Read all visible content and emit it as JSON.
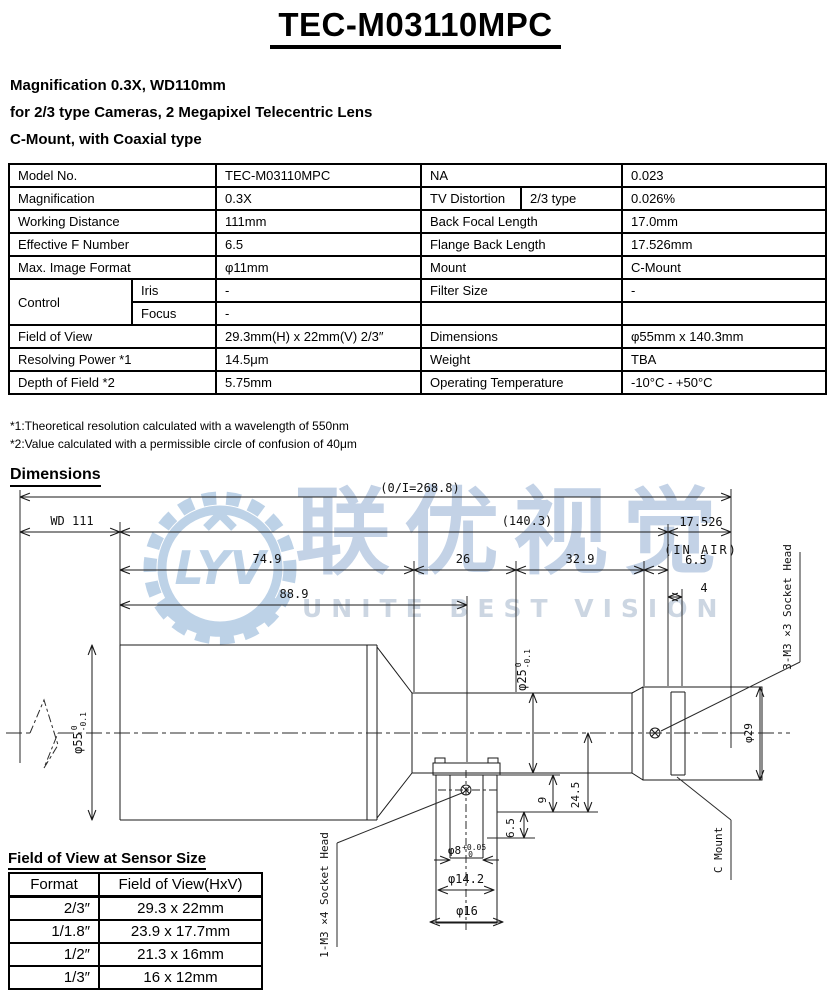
{
  "title": "TEC-M03110MPC",
  "description_lines": [
    "Magnification 0.3X, WD110mm",
    "for 2/3 type Cameras, 2 Megapixel Telecentric Lens",
    "C-Mount, with Coaxial type"
  ],
  "spec_table": {
    "rows": [
      [
        "Model No.",
        "TEC-M03110MPC",
        "NA",
        "0.023"
      ],
      [
        "Magnification",
        "0.3X",
        "TV Distortion",
        "2/3 type",
        "0.026%"
      ],
      [
        "Working Distance",
        "111mm",
        "Back Focal Length",
        "17.0mm"
      ],
      [
        "Effective F Number",
        "6.5",
        "Flange Back Length",
        "17.526mm"
      ],
      [
        "Max. Image Format",
        "φ11mm",
        "Mount",
        "C-Mount"
      ],
      [
        "Control",
        "Iris",
        "-",
        "Filter Size",
        "-"
      ],
      [
        "Focus",
        "-",
        "",
        ""
      ],
      [
        "Field of View",
        "29.3mm(H) x 22mm(V) 2/3″",
        "Dimensions",
        "φ55mm x 140.3mm"
      ],
      [
        "Resolving Power *1",
        "14.5μm",
        "Weight",
        "TBA"
      ],
      [
        "Depth of Field *2",
        "5.75mm",
        "Operating Temperature",
        "-10°C - +50°C"
      ]
    ]
  },
  "footnotes": [
    "*1:Theoretical resolution calculated with a wavelength of 550nm",
    "*2:Value calculated with a permissible circle of confusion of 40μm"
  ],
  "dimensions_heading": "Dimensions",
  "watermark": {
    "logo_monogram": "LYV",
    "text_cn": "联优视觉",
    "text_en": "UNITE BEST VISION",
    "logo_color": "#bdd2e7"
  },
  "drawing": {
    "overall": "(0/I=268.8)",
    "wd": "WD 111",
    "body_len": "(140.3)",
    "flange_back": "17.526",
    "in_air": "(IN AIR)",
    "seg_74_9": "74.9",
    "seg_26": "26",
    "seg_32_9": "32.9",
    "seg_6_5": "6.5",
    "seg_4": "4",
    "seg_88_9": "88.9",
    "dia55": "φ55",
    "dia55_tol_u": "0",
    "dia55_tol_l": "-0.1",
    "dia25": "φ25",
    "dia25_tol_u": "0",
    "dia25_tol_l": "-0.1",
    "dia29": "φ29",
    "dia8": "φ8",
    "dia8_tol_u": "+0.05",
    "dia8_tol_l": "0",
    "dia14_2": "φ14.2",
    "dia16": "φ16",
    "v24_5": "24.5",
    "v9": "9",
    "v6_5": "6.5",
    "screw_rear": "3-M3 ×3 Socket Head",
    "screw_port": "1-M3 ×4 Socket Head",
    "c_mount": "C Mount"
  },
  "fov_table": {
    "heading": "Field of View at Sensor Size",
    "columns": [
      "Format",
      "Field of View(HxV)"
    ],
    "rows": [
      [
        "2/3″",
        "29.3 x 22mm"
      ],
      [
        "1/1.8″",
        "23.9 x 17.7mm"
      ],
      [
        "1/2″",
        "21.3 x 16mm"
      ],
      [
        "1/3″",
        "16 x 12mm"
      ]
    ]
  }
}
